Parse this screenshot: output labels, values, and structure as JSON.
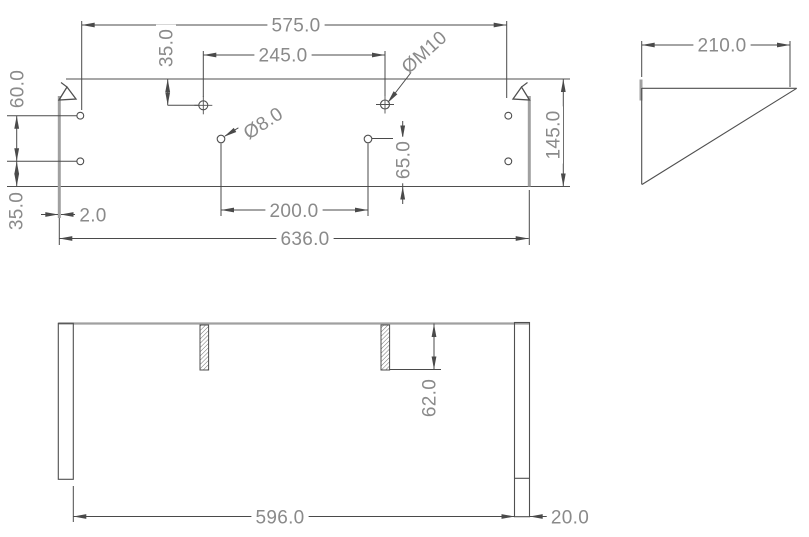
{
  "drawing": {
    "canvas": {
      "width": 809,
      "height": 537,
      "background": "#ffffff"
    },
    "styles": {
      "object_line_color": "#4f4f4f",
      "dimension_line_color": "#4a4a4a",
      "thick_edge_color": "#a0a0a0",
      "text_color": "#8a8a8a",
      "hatch_color": "#6f6f6f",
      "font_size": 19
    },
    "elements": [
      {
        "view": "front",
        "type": "line",
        "name": "front-plate-top-edge",
        "s": "obj",
        "x1": 66,
        "y1": 79,
        "x2": 570,
        "y2": 79
      },
      {
        "view": "front",
        "type": "line",
        "name": "front-plate-bottom-edge",
        "s": "obj",
        "x1": 7,
        "y1": 186.5,
        "x2": 570,
        "y2": 186.5
      },
      {
        "view": "front",
        "type": "line",
        "name": "front-left-side-panel-edge",
        "s": "thick",
        "x1": 59.3,
        "y1": 96,
        "x2": 59.3,
        "y2": 218
      },
      {
        "view": "front",
        "type": "line",
        "name": "front-right-side-panel-edge",
        "s": "thick",
        "x1": 529.3,
        "y1": 96,
        "x2": 529.3,
        "y2": 186.5
      },
      {
        "view": "front",
        "type": "poly",
        "name": "front-left-corner-tab",
        "s": "obj",
        "points": "59,100 67,87 76,99"
      },
      {
        "view": "front",
        "type": "line",
        "name": "front-left-corner-tab-tail",
        "s": "obj",
        "x1": 67,
        "y1": 87,
        "x2": 61,
        "y2": 82.5
      },
      {
        "view": "front",
        "type": "poly",
        "name": "front-right-corner-tab",
        "s": "obj",
        "points": "529.5,100 521.5,87 513,99"
      },
      {
        "view": "front",
        "type": "line",
        "name": "front-right-corner-tab-tail",
        "s": "obj",
        "x1": 521.5,
        "y1": 87,
        "x2": 527.5,
        "y2": 82.5
      },
      {
        "view": "front",
        "type": "circle",
        "name": "hole-side-left-upper",
        "s": "obj",
        "cx": 80.3,
        "cy": 115.7,
        "r": 3.4
      },
      {
        "view": "front",
        "type": "circle",
        "name": "hole-side-left-lower",
        "s": "obj",
        "cx": 80.3,
        "cy": 161.3,
        "r": 3.4
      },
      {
        "view": "front",
        "type": "circle",
        "name": "hole-side-right-upper",
        "s": "obj",
        "cx": 508.3,
        "cy": 115.7,
        "r": 3.4
      },
      {
        "view": "front",
        "type": "circle",
        "name": "hole-side-right-lower",
        "s": "obj",
        "cx": 508.3,
        "cy": 161.3,
        "r": 3.4
      },
      {
        "view": "front",
        "type": "crosscircle",
        "name": "hole-m10-left",
        "s": "obj",
        "cx": 203.3,
        "cy": 105.3,
        "r": 4.5,
        "ext": 4.5
      },
      {
        "view": "front",
        "type": "crosscircle",
        "name": "hole-m10-right",
        "s": "obj",
        "cx": 385,
        "cy": 104.5,
        "r": 4.5,
        "ext": 4.5
      },
      {
        "view": "front",
        "type": "circle",
        "name": "hole-d8-left",
        "s": "obj",
        "cx": 221,
        "cy": 139,
        "r": 3.8
      },
      {
        "view": "front",
        "type": "circle",
        "name": "hole-d8-right",
        "s": "obj",
        "cx": 368,
        "cy": 139,
        "r": 3.8
      },
      {
        "view": "front",
        "type": "line",
        "name": "centerline-left-upper-hole",
        "s": "dim",
        "x1": 7,
        "y1": 115.7,
        "x2": 76.5,
        "y2": 115.7
      },
      {
        "view": "front",
        "type": "line",
        "name": "centerline-left-lower-hole",
        "s": "dim",
        "x1": 7,
        "y1": 161.3,
        "x2": 76.5,
        "y2": 161.3
      },
      {
        "view": "front",
        "type": "line",
        "name": "dim-575-ext-left",
        "s": "dim",
        "x1": 81.7,
        "y1": 21,
        "x2": 81.7,
        "y2": 110
      },
      {
        "view": "front",
        "type": "line",
        "name": "dim-575-ext-right",
        "s": "dim",
        "x1": 506.7,
        "y1": 21,
        "x2": 506.7,
        "y2": 98
      },
      {
        "view": "front",
        "type": "line",
        "name": "dim-575-line",
        "s": "dim",
        "x1": 81.7,
        "y1": 25,
        "x2": 506.7,
        "y2": 25
      },
      {
        "view": "front",
        "type": "arrow",
        "name": "dim-575-arrow-left",
        "x": 81.7,
        "y": 25,
        "a": 180
      },
      {
        "view": "front",
        "type": "arrow",
        "name": "dim-575-arrow-right",
        "x": 506.7,
        "y": 25,
        "a": 0
      },
      {
        "view": "front",
        "type": "label",
        "name": "dim-575-label",
        "text": "575.0",
        "x": 296,
        "y": 25,
        "rot": 0
      },
      {
        "view": "front",
        "type": "line",
        "name": "dim-245-ext-left",
        "s": "dim",
        "x1": 203.3,
        "y1": 51,
        "x2": 203.3,
        "y2": 97
      },
      {
        "view": "front",
        "type": "line",
        "name": "dim-245-ext-right",
        "s": "dim",
        "x1": 385,
        "y1": 51,
        "x2": 385,
        "y2": 96
      },
      {
        "view": "front",
        "type": "line",
        "name": "dim-245-line",
        "s": "dim",
        "x1": 203.3,
        "y1": 55,
        "x2": 385,
        "y2": 55
      },
      {
        "view": "front",
        "type": "arrow",
        "name": "dim-245-arrow-left",
        "x": 203.3,
        "y": 55,
        "a": 180
      },
      {
        "view": "front",
        "type": "arrow",
        "name": "dim-245-arrow-right",
        "x": 385,
        "y": 55,
        "a": 0
      },
      {
        "view": "front",
        "type": "label",
        "name": "dim-245-label",
        "text": "245.0",
        "x": 283,
        "y": 55,
        "rot": 0
      },
      {
        "view": "front",
        "type": "line",
        "name": "dim-35-top-line",
        "s": "dim",
        "x1": 167.7,
        "y1": 79,
        "x2": 167.7,
        "y2": 105.3
      },
      {
        "view": "front",
        "type": "arrow",
        "name": "dim-35-top-arrow-up",
        "x": 167.7,
        "y": 79,
        "a": -90
      },
      {
        "view": "front",
        "type": "arrow",
        "name": "dim-35-top-arrow-down",
        "x": 167.7,
        "y": 105.3,
        "a": 90
      },
      {
        "view": "front",
        "type": "line",
        "name": "dim-35-top-ext",
        "s": "dim",
        "x1": 167.7,
        "y1": 105.3,
        "x2": 198.5,
        "y2": 105.3
      },
      {
        "view": "front",
        "type": "label",
        "name": "dim-35-top-label",
        "text": "35.0",
        "x": 166,
        "y": 48,
        "rot": -90
      },
      {
        "view": "front",
        "type": "line",
        "name": "leader-m10-line",
        "s": "dim",
        "x1": 389,
        "y1": 101,
        "x2": 413,
        "y2": 70
      },
      {
        "view": "front",
        "type": "arrow",
        "name": "leader-m10-arrow",
        "x": 387.5,
        "y": 103,
        "a": 128
      },
      {
        "view": "front",
        "type": "label",
        "name": "label-m10",
        "text": "ØM10",
        "x": 424,
        "y": 52,
        "rot": -42
      },
      {
        "view": "front",
        "type": "line",
        "name": "leader-d8-line",
        "s": "dim",
        "x1": 225,
        "y1": 136,
        "x2": 243,
        "y2": 125
      },
      {
        "view": "front",
        "type": "arrow",
        "name": "leader-d8-arrow",
        "x": 224,
        "y": 136.8,
        "a": 148
      },
      {
        "view": "front",
        "type": "label",
        "name": "label-d8",
        "text": "Ø8.0",
        "x": 263,
        "y": 123,
        "rot": -33
      },
      {
        "view": "front",
        "type": "line",
        "name": "dim-65-ext",
        "s": "dim",
        "x1": 371.8,
        "y1": 138.5,
        "x2": 406.5,
        "y2": 138.5
      },
      {
        "view": "front",
        "type": "line",
        "name": "dim-65-line",
        "s": "dim",
        "x1": 402.7,
        "y1": 138.5,
        "x2": 402.7,
        "y2": 186.5
      },
      {
        "view": "front",
        "type": "line",
        "name": "dim-65-arrow-shaft-top",
        "s": "dim",
        "x1": 402.7,
        "y1": 121,
        "x2": 402.7,
        "y2": 138.5
      },
      {
        "view": "front",
        "type": "arrow",
        "name": "dim-65-arrow-top",
        "x": 402.7,
        "y": 138.5,
        "a": 90
      },
      {
        "view": "front",
        "type": "line",
        "name": "dim-65-arrow-shaft-bottom",
        "s": "dim",
        "x1": 402.7,
        "y1": 186.5,
        "x2": 402.7,
        "y2": 204
      },
      {
        "view": "front",
        "type": "arrow",
        "name": "dim-65-arrow-bottom",
        "x": 402.7,
        "y": 186.5,
        "a": -90
      },
      {
        "view": "front",
        "type": "label",
        "name": "dim-65-label",
        "text": "65.0",
        "x": 403,
        "y": 160,
        "rot": -90
      },
      {
        "view": "front",
        "type": "line",
        "name": "dim-60-line",
        "s": "dim",
        "x1": 16.7,
        "y1": 115.7,
        "x2": 16.7,
        "y2": 161.3
      },
      {
        "view": "front",
        "type": "arrow",
        "name": "dim-60-arrow-up",
        "x": 16.7,
        "y": 115.7,
        "a": -90
      },
      {
        "view": "front",
        "type": "arrow",
        "name": "dim-60-arrow-down",
        "x": 16.7,
        "y": 161.3,
        "a": 90
      },
      {
        "view": "front",
        "type": "label",
        "name": "dim-60-label",
        "text": "60.0",
        "x": 17,
        "y": 89,
        "rot": -90
      },
      {
        "view": "front",
        "type": "line",
        "name": "dim-35-left-line",
        "s": "dim",
        "x1": 16.7,
        "y1": 161.3,
        "x2": 16.7,
        "y2": 186.5
      },
      {
        "view": "front",
        "type": "arrow",
        "name": "dim-35-left-arrow-up",
        "x": 16.7,
        "y": 161.3,
        "a": -90
      },
      {
        "view": "front",
        "type": "arrow",
        "name": "dim-35-left-arrow-down",
        "x": 16.7,
        "y": 186.5,
        "a": 90
      },
      {
        "view": "front",
        "type": "label",
        "name": "dim-35-left-label",
        "text": "35.0",
        "x": 16,
        "y": 211,
        "rot": -90
      },
      {
        "view": "front",
        "type": "line",
        "name": "dim-2-arrow-shaft-left",
        "s": "dim",
        "x1": 41,
        "y1": 214.5,
        "x2": 58,
        "y2": 214.5
      },
      {
        "view": "front",
        "type": "arrow",
        "name": "dim-2-arrow-left",
        "x": 58.3,
        "y": 214.5,
        "a": 0
      },
      {
        "view": "front",
        "type": "line",
        "name": "dim-2-arrow-shaft-right",
        "s": "dim",
        "x1": 61,
        "y1": 214.5,
        "x2": 79,
        "y2": 214.5
      },
      {
        "view": "front",
        "type": "arrow",
        "name": "dim-2-arrow-right",
        "x": 60.5,
        "y": 214.5,
        "a": 180
      },
      {
        "view": "front",
        "type": "label",
        "name": "dim-2-label",
        "text": "2.0",
        "x": 93,
        "y": 215,
        "rot": 0
      },
      {
        "view": "front",
        "type": "line",
        "name": "dim-145-line",
        "s": "dim",
        "x1": 563.3,
        "y1": 79,
        "x2": 563.3,
        "y2": 186.5
      },
      {
        "view": "front",
        "type": "arrow",
        "name": "dim-145-arrow-up",
        "x": 563.3,
        "y": 79,
        "a": -90
      },
      {
        "view": "front",
        "type": "arrow",
        "name": "dim-145-arrow-down",
        "x": 563.3,
        "y": 186.5,
        "a": 90
      },
      {
        "view": "front",
        "type": "label",
        "name": "dim-145-label",
        "text": "145.0",
        "x": 553,
        "y": 135,
        "rot": -90
      },
      {
        "view": "front",
        "type": "line",
        "name": "dim-200-ext-left",
        "s": "dim",
        "x1": 221,
        "y1": 143.5,
        "x2": 221,
        "y2": 216
      },
      {
        "view": "front",
        "type": "line",
        "name": "dim-200-ext-right",
        "s": "dim",
        "x1": 368,
        "y1": 143.5,
        "x2": 368,
        "y2": 216
      },
      {
        "view": "front",
        "type": "line",
        "name": "dim-200-line",
        "s": "dim",
        "x1": 221,
        "y1": 210,
        "x2": 368,
        "y2": 210
      },
      {
        "view": "front",
        "type": "arrow",
        "name": "dim-200-arrow-left",
        "x": 221,
        "y": 210,
        "a": 180
      },
      {
        "view": "front",
        "type": "arrow",
        "name": "dim-200-arrow-right",
        "x": 368,
        "y": 210,
        "a": 0
      },
      {
        "view": "front",
        "type": "label",
        "name": "dim-200-label",
        "text": "200.0",
        "x": 294,
        "y": 210.5,
        "rot": 0
      },
      {
        "view": "front",
        "type": "line",
        "name": "dim-636-ext-left",
        "s": "dim",
        "x1": 59.3,
        "y1": 218,
        "x2": 59.3,
        "y2": 245
      },
      {
        "view": "front",
        "type": "line",
        "name": "dim-636-ext-right",
        "s": "dim",
        "x1": 529.3,
        "y1": 190,
        "x2": 529.3,
        "y2": 245
      },
      {
        "view": "front",
        "type": "line",
        "name": "dim-636-line",
        "s": "dim",
        "x1": 59.3,
        "y1": 238.5,
        "x2": 528.7,
        "y2": 238.5
      },
      {
        "view": "front",
        "type": "arrow",
        "name": "dim-636-arrow-left",
        "x": 59.3,
        "y": 238.5,
        "a": 180
      },
      {
        "view": "front",
        "type": "arrow",
        "name": "dim-636-arrow-right",
        "x": 528.7,
        "y": 238.5,
        "a": 0
      },
      {
        "view": "front",
        "type": "label",
        "name": "dim-636-label",
        "text": "636.0",
        "x": 305,
        "y": 238.5,
        "rot": 0
      },
      {
        "view": "side",
        "type": "line",
        "name": "dim-210-ext-left",
        "s": "dim",
        "x1": 641.7,
        "y1": 41,
        "x2": 641.7,
        "y2": 77
      },
      {
        "view": "side",
        "type": "line",
        "name": "dim-210-ext-right",
        "s": "dim",
        "x1": 790,
        "y1": 41,
        "x2": 790,
        "y2": 87
      },
      {
        "view": "side",
        "type": "line",
        "name": "dim-210-line",
        "s": "dim",
        "x1": 641.7,
        "y1": 45,
        "x2": 790,
        "y2": 45
      },
      {
        "view": "side",
        "type": "arrow",
        "name": "dim-210-arrow-left",
        "x": 641.7,
        "y": 45,
        "a": 180
      },
      {
        "view": "side",
        "type": "arrow",
        "name": "dim-210-arrow-right",
        "x": 790,
        "y": 45,
        "a": 0
      },
      {
        "view": "side",
        "type": "label",
        "name": "dim-210-label",
        "text": "210.0",
        "x": 722,
        "y": 45,
        "rot": 0
      },
      {
        "view": "side",
        "type": "line",
        "name": "side-back-plate-edge",
        "s": "thick",
        "x1": 641,
        "y1": 79.5,
        "x2": 641,
        "y2": 100.5
      },
      {
        "view": "side",
        "type": "line",
        "name": "side-gusset-left-edge",
        "s": "obj",
        "x1": 641.7,
        "y1": 88,
        "x2": 641.7,
        "y2": 184.5
      },
      {
        "view": "side",
        "type": "line",
        "name": "side-gusset-top-edge",
        "s": "obj",
        "x1": 642,
        "y1": 88.3,
        "x2": 796.7,
        "y2": 88.3
      },
      {
        "view": "side",
        "type": "line",
        "name": "side-gusset-hypotenuse",
        "s": "obj",
        "x1": 796.7,
        "y1": 88.3,
        "x2": 642,
        "y2": 184.5
      },
      {
        "view": "bottom",
        "type": "line",
        "name": "bottom-back-edge",
        "s": "edge2",
        "x1": 58.3,
        "y1": 323.5,
        "x2": 530,
        "y2": 323.5
      },
      {
        "view": "bottom",
        "type": "rect",
        "name": "bottom-left-side-panel",
        "s": "obj",
        "x": 58.3,
        "y": 323.3,
        "w": 15,
        "h": 156
      },
      {
        "view": "bottom",
        "type": "rect",
        "name": "bottom-right-side-panel",
        "s": "obj",
        "x": 514.5,
        "y": 322.5,
        "w": 15,
        "h": 194.2
      },
      {
        "view": "bottom",
        "type": "line",
        "name": "bottom-right-panel-tick",
        "s": "obj",
        "x1": 514.5,
        "y1": 478.3,
        "x2": 529.5,
        "y2": 478.3
      },
      {
        "view": "bottom",
        "type": "hatch",
        "name": "bottom-slot-left",
        "x": 200,
        "y": 325,
        "w": 8.6,
        "h": 45
      },
      {
        "view": "bottom",
        "type": "hatch",
        "name": "bottom-slot-right",
        "x": 381,
        "y": 325,
        "w": 8.6,
        "h": 45
      },
      {
        "view": "bottom",
        "type": "line",
        "name": "dim-62-ext",
        "s": "dim",
        "x1": 389.6,
        "y1": 369.5,
        "x2": 441,
        "y2": 369.5
      },
      {
        "view": "bottom",
        "type": "line",
        "name": "dim-62-line",
        "s": "dim",
        "x1": 434,
        "y1": 323.5,
        "x2": 434,
        "y2": 369.5
      },
      {
        "view": "bottom",
        "type": "arrow",
        "name": "dim-62-arrow-up",
        "x": 434,
        "y": 324,
        "a": -90
      },
      {
        "view": "bottom",
        "type": "arrow",
        "name": "dim-62-arrow-down",
        "x": 434,
        "y": 369.5,
        "a": 90
      },
      {
        "view": "bottom",
        "type": "label",
        "name": "dim-62-label",
        "text": "62.0",
        "x": 429,
        "y": 398,
        "rot": -90
      },
      {
        "view": "bottom",
        "type": "line",
        "name": "dim-596-ext-left",
        "s": "dim",
        "x1": 73.3,
        "y1": 486,
        "x2": 73.3,
        "y2": 522
      },
      {
        "view": "bottom",
        "type": "line",
        "name": "dim-596-line",
        "s": "dim",
        "x1": 73.3,
        "y1": 516.5,
        "x2": 514.5,
        "y2": 516.5
      },
      {
        "view": "bottom",
        "type": "arrow",
        "name": "dim-596-arrow-left",
        "x": 73.3,
        "y": 516.5,
        "a": 180
      },
      {
        "view": "bottom",
        "type": "arrow",
        "name": "dim-596-arrow-right",
        "x": 514.5,
        "y": 516.5,
        "a": 0
      },
      {
        "view": "bottom",
        "type": "label",
        "name": "dim-596-label",
        "text": "596.0",
        "x": 280,
        "y": 517,
        "rot": 0
      },
      {
        "view": "bottom",
        "type": "line",
        "name": "dim-20-arrow-shaft",
        "s": "dim",
        "x1": 530,
        "y1": 516.5,
        "x2": 549,
        "y2": 516.5
      },
      {
        "view": "bottom",
        "type": "arrow",
        "name": "dim-20-arrow-right",
        "x": 529.7,
        "y": 516.5,
        "a": 180
      },
      {
        "view": "bottom",
        "type": "label",
        "name": "dim-20-label",
        "text": "20.0",
        "x": 570,
        "y": 517,
        "rot": 0
      }
    ]
  }
}
